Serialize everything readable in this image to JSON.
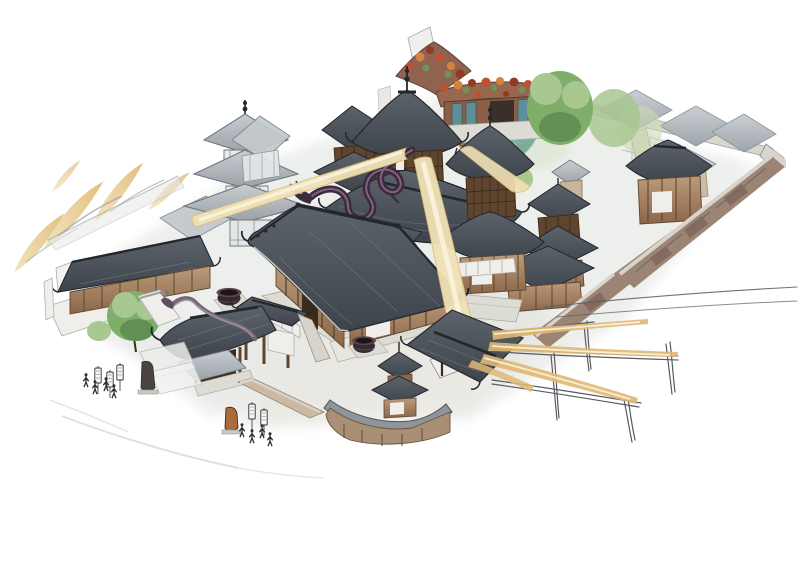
{
  "canvas": {
    "width": 800,
    "height": 579,
    "background": "#ffffff",
    "title": "Watercolor isometric illustration of a walled Chinese temple monastery with golden light beams, a dragon coiled on the central pavilion roofs, courtyard halls, pagoda, pond and sketched fence frames"
  },
  "colors": {
    "background": "#ffffff",
    "roof_dark": "#3e444b",
    "roof_mid": "#5c636a",
    "roof_light": "#9aa1a7",
    "roof_sketch": "#c8cdd1",
    "ridge_ink": "#24272c",
    "eave_light": "#dddcd6",
    "wood": "#8b6749",
    "wood_dark": "#5f452e",
    "wood_deep": "#3c2a1a",
    "wood_light": "#bb9b7b",
    "stone": "#dcdcd5",
    "stone_dark": "#b2b2aa",
    "white_wall": "#efeeea",
    "beam_gold": "#dfb873",
    "beam_pale": "#f0e2b6",
    "beam_core": "#faf3dd",
    "dragon_dark": "#3c2a3e",
    "dragon_mid": "#5d4458",
    "dragon_light": "#8d6d88",
    "gate_dragon": "#776877",
    "tree_green": "#7fae6b",
    "tree_light": "#a9c790",
    "tree_dark": "#5d8a4e",
    "tree_wash": "#c9dcb6",
    "pond_teal": "#8fbcab",
    "pond_deep": "#6fa392",
    "flower_red": "#bf5130",
    "flower_orange": "#d8823f",
    "flower_deep": "#8f3b24",
    "leaf_green": "#6f9455",
    "teal_door": "#5f9097",
    "wall_face": "#9b8474",
    "wall_panel": "#7d665a",
    "wall_top": "#d9d4cb",
    "pencil": "#565b61",
    "ink": "#2c3036",
    "bronze": "#a96a3c",
    "bronze_dark": "#6e4526",
    "wash_gray": "#eceeec",
    "wash_warm": "#e9e4da"
  }
}
